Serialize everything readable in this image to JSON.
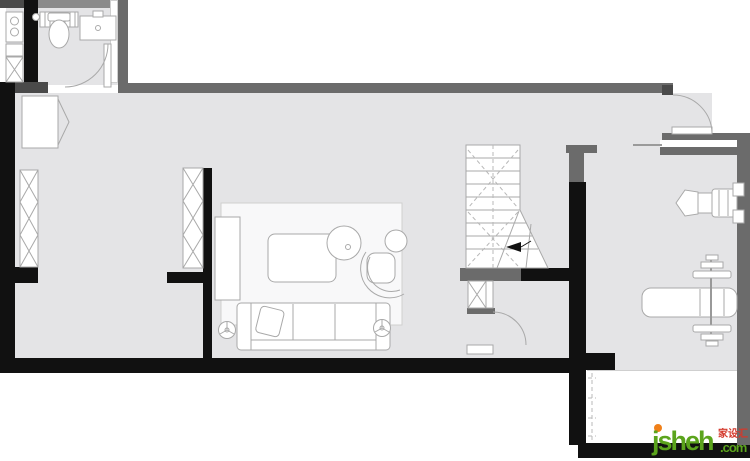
{
  "watermark": {
    "brand": "jsheh",
    "tld": ".com",
    "cn": "家设汇"
  },
  "colors": {
    "floor": "#e4e4e6",
    "wall_black": "#111111",
    "wall_gray": "#6b6b6b",
    "furniture_outline": "#a9a9a9",
    "wm_green": "#5ba41c",
    "wm_orange": "#f08019",
    "wm_red": "#d4392c"
  }
}
